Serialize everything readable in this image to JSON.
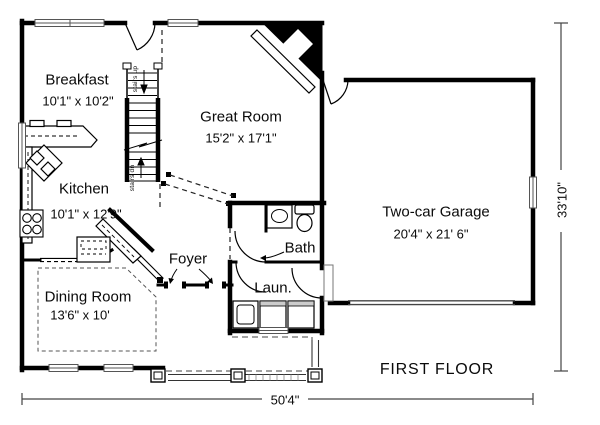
{
  "plan": {
    "title": "FIRST FLOOR",
    "overall": {
      "width": "50'4\"",
      "depth": "33'10\""
    },
    "rooms": {
      "breakfast": {
        "name": "Breakfast",
        "dims": "10'1\" x 10'2\""
      },
      "great_room": {
        "name": "Great Room",
        "dims": "15'2\" x 17'1\""
      },
      "kitchen": {
        "name": "Kitchen",
        "dims": "10'1\" x 12'9\""
      },
      "dining_room": {
        "name": "Dining Room",
        "dims": "13'6\" x 10'"
      },
      "foyer": {
        "name": "Foyer"
      },
      "bath": {
        "name": "Bath"
      },
      "laundry": {
        "name": "Laun."
      },
      "garage": {
        "name": "Two-car Garage",
        "dims": "20'4\" x 21' 6\""
      }
    },
    "stairs": {
      "up_label": "stairs up",
      "down_label": "stairs dn"
    },
    "colors": {
      "wall": "#000000",
      "thin_line": "#333333",
      "window_line": "#555555",
      "background": "#ffffff"
    }
  }
}
